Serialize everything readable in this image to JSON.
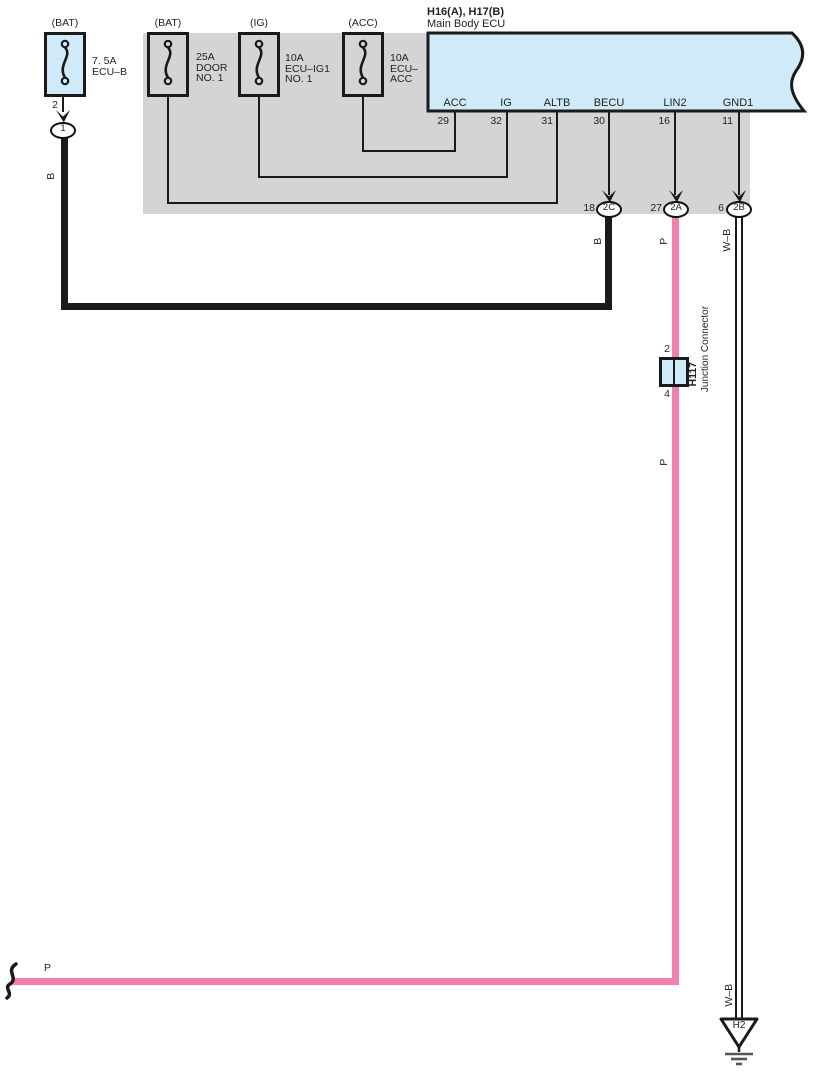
{
  "ecu": {
    "title": "H16(A), H17(B)",
    "subtitle": "Main Body ECU",
    "pins": [
      {
        "name": "ACC",
        "number": "29"
      },
      {
        "name": "IG",
        "number": "32"
      },
      {
        "name": "ALTB",
        "number": "31"
      },
      {
        "name": "BECU",
        "number": "30"
      },
      {
        "name": "LIN2",
        "number": "16"
      },
      {
        "name": "GND1",
        "number": "11"
      }
    ]
  },
  "fuses": [
    {
      "source": "(BAT)",
      "label": "7. 5A\nECU–B"
    },
    {
      "source": "(BAT)",
      "label": "25A\nDOOR\nNO. 1"
    },
    {
      "source": "(IG)",
      "label": "10A\nECU–IG1\nNO. 1"
    },
    {
      "source": "(ACC)",
      "label": "10A\nECU–\nACC"
    }
  ],
  "connectors": {
    "fuse1_pin": "2",
    "fuse1_terminal": "1",
    "becu": {
      "pin": "18",
      "terminal": "2C"
    },
    "lin2": {
      "pin": "27",
      "terminal": "2A"
    },
    "gnd1": {
      "pin": "6",
      "terminal": "2B"
    }
  },
  "junction": {
    "pin_top": "2",
    "pin_bottom": "4",
    "name": "H117",
    "type": "Junction Connector"
  },
  "ground": {
    "name": "H2"
  },
  "wire_labels": {
    "black": "B",
    "pink": "P",
    "white_black": "W–B"
  },
  "colors": {
    "pink_wire": "#f180b0",
    "light_blue_fill": "#cfeaf8",
    "shade_gray": "#d4d4d4",
    "line_black": "#1a1a1a"
  }
}
